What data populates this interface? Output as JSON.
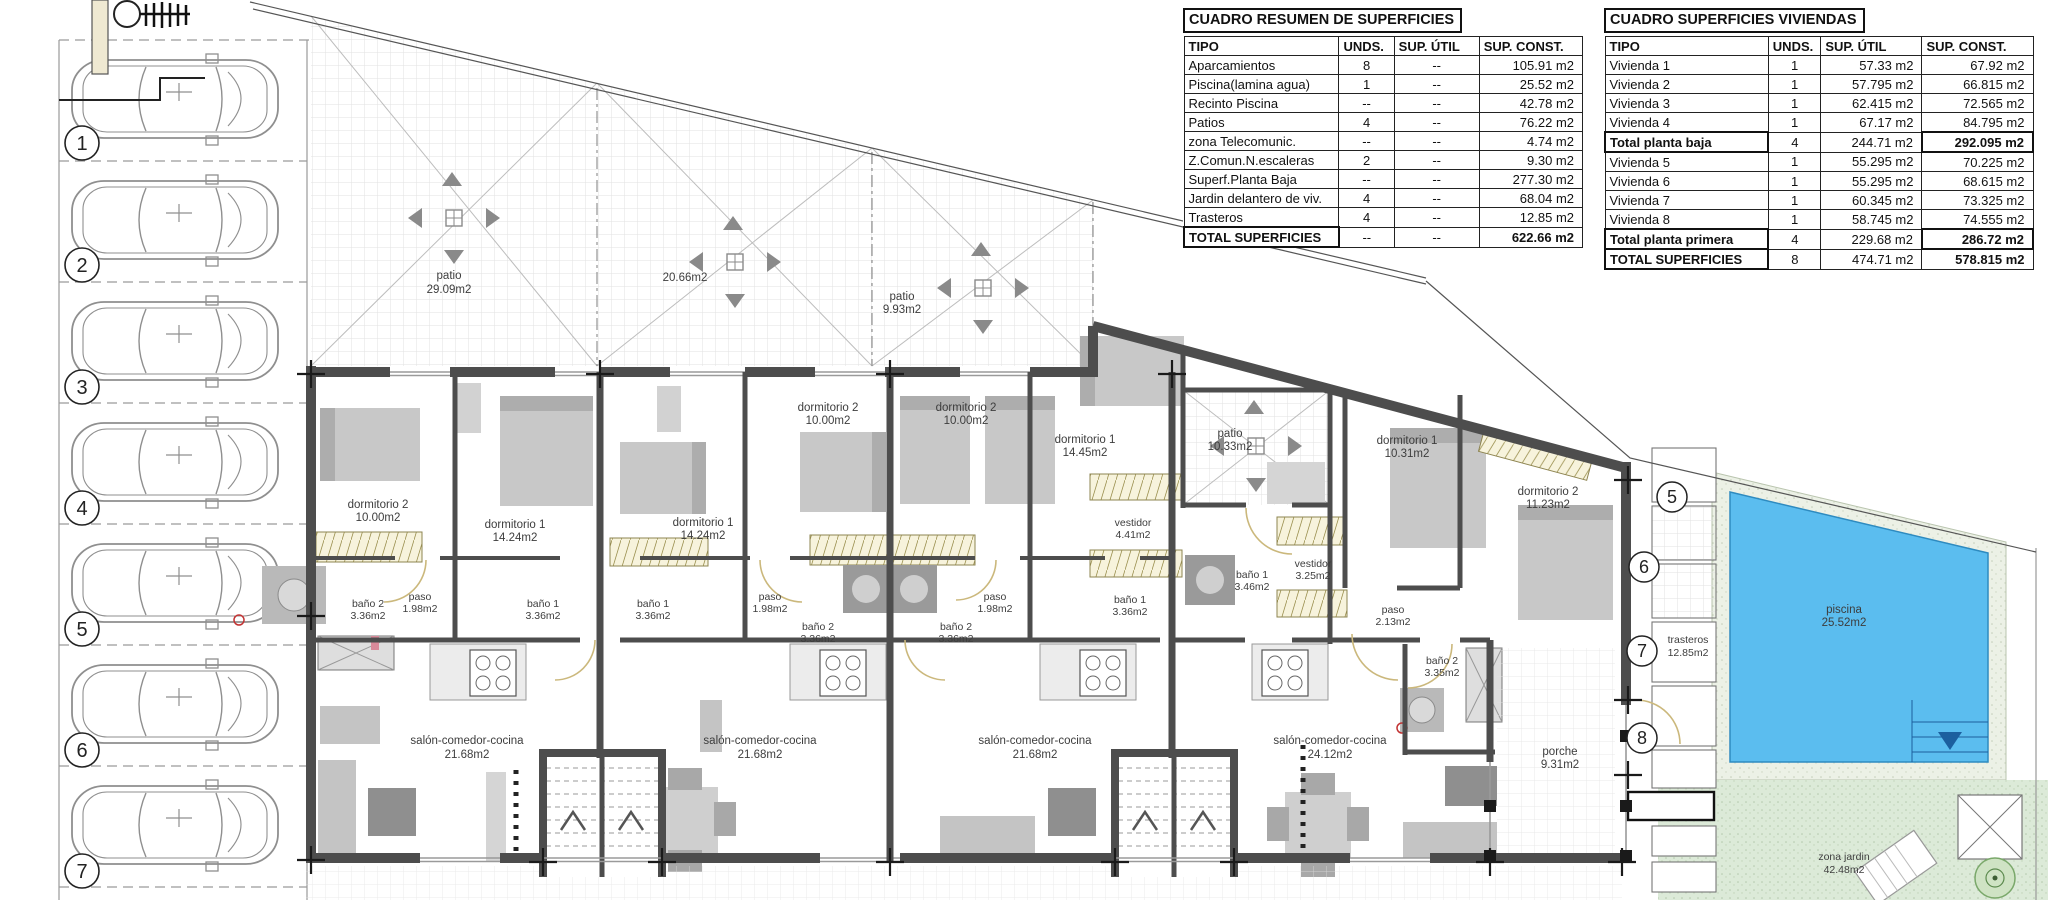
{
  "tables": {
    "resumen": {
      "title": "CUADRO RESUMEN DE SUPERFICIES",
      "headers": [
        "TIPO",
        "UNDS.",
        "SUP. ÚTIL",
        "SUP. CONST."
      ],
      "rows": [
        [
          "Aparcamientos",
          "8",
          "--",
          "105.91 m2"
        ],
        [
          "Piscina(lamina agua)",
          "1",
          "--",
          "25.52 m2"
        ],
        [
          "Recinto Piscina",
          "--",
          "--",
          "42.78 m2"
        ],
        [
          "Patios",
          "4",
          "--",
          "76.22 m2"
        ],
        [
          "zona Telecomunic.",
          "--",
          "--",
          "4.74 m2"
        ],
        [
          "Z.Comun.N.escaleras",
          "2",
          "--",
          "9.30 m2"
        ],
        [
          "Superf.Planta Baja",
          "--",
          "--",
          "277.30 m2"
        ],
        [
          "Jardin delantero de viv.",
          "4",
          "--",
          "68.04 m2"
        ],
        [
          "Trasteros",
          "4",
          "--",
          "12.85 m2"
        ]
      ],
      "total": [
        "TOTAL SUPERFICIES",
        "--",
        "--",
        "622.66 m2"
      ]
    },
    "viviendas": {
      "title": "CUADRO SUPERFICIES VIVIENDAS",
      "headers": [
        "TIPO",
        "UNDS.",
        "SUP. ÚTIL",
        "SUP. CONST."
      ],
      "rows": [
        [
          "Vivienda 1",
          "1",
          "57.33 m2",
          "67.92 m2"
        ],
        [
          "Vivienda 2",
          "1",
          "57.795 m2",
          "66.815 m2"
        ],
        [
          "Vivienda 3",
          "1",
          "62.415 m2",
          "72.565 m2"
        ],
        [
          "Vivienda 4",
          "1",
          "67.17 m2",
          "84.795 m2"
        ],
        [
          "Total planta baja",
          "4",
          "244.71 m2",
          "292.095 m2"
        ],
        [
          "Vivienda 5",
          "1",
          "55.295 m2",
          "70.225 m2"
        ],
        [
          "Vivienda 6",
          "1",
          "55.295 m2",
          "68.615 m2"
        ],
        [
          "Vivienda 7",
          "1",
          "60.345 m2",
          "73.325 m2"
        ],
        [
          "Vivienda 8",
          "1",
          "58.745 m2",
          "74.555 m2"
        ],
        [
          "Total planta primera",
          "4",
          "229.68 m2",
          "286.72 m2"
        ],
        [
          "TOTAL SUPERFICIES",
          "8",
          "474.71 m2",
          "578.815 m2"
        ]
      ]
    }
  },
  "plan": {
    "parking_numbers": [
      "1",
      "2",
      "3",
      "4",
      "5",
      "6",
      "7"
    ],
    "plot_numbers": [
      "5",
      "6",
      "7",
      "8"
    ],
    "labels": [
      {
        "name": "patio",
        "area": "29.09m2"
      },
      {
        "name": "",
        "area": "20.66m2"
      },
      {
        "name": "patio",
        "area": "9.93m2"
      },
      {
        "name": "patio",
        "area": "10.33m2"
      },
      {
        "name": "dormitorio 2",
        "area": "10.00m2"
      },
      {
        "name": "dormitorio 1",
        "area": "14.24m2"
      },
      {
        "name": "dormitorio 1",
        "area": "14.24m2"
      },
      {
        "name": "dormitorio 2",
        "area": "10.00m2"
      },
      {
        "name": "dormitorio 2",
        "area": "10.00m2"
      },
      {
        "name": "dormitorio 1",
        "area": "14.45m2"
      },
      {
        "name": "dormitorio 1",
        "area": "10.31m2"
      },
      {
        "name": "dormitorio 2",
        "area": "11.23m2"
      },
      {
        "name": "vestidor",
        "area": "4.41m2"
      },
      {
        "name": "vestidor",
        "area": "3.25m2"
      },
      {
        "name": "baño 2",
        "area": "3.36m2"
      },
      {
        "name": "paso",
        "area": "1.98m2"
      },
      {
        "name": "baño 1",
        "area": "3.36m2"
      },
      {
        "name": "baño 1",
        "area": "3.36m2"
      },
      {
        "name": "paso",
        "area": "1.98m2"
      },
      {
        "name": "baño 2",
        "area": "3.36m2"
      },
      {
        "name": "baño 2",
        "area": "3.36m2"
      },
      {
        "name": "paso",
        "area": "1.98m2"
      },
      {
        "name": "baño 1",
        "area": "3.46m2"
      },
      {
        "name": "baño 1",
        "area": "3.36m2"
      },
      {
        "name": "paso",
        "area": "2.13m2"
      },
      {
        "name": "baño 2",
        "area": "3.35m2"
      },
      {
        "name": "salón-comedor-cocina",
        "area": "21.68m2"
      },
      {
        "name": "salón-comedor-cocina",
        "area": "21.68m2"
      },
      {
        "name": "salón-comedor-cocina",
        "area": "21.68m2"
      },
      {
        "name": "salón-comedor-cocina",
        "area": "24.12m2"
      },
      {
        "name": "porche",
        "area": "9.31m2"
      },
      {
        "name": "trasteros",
        "area": "12.85m2"
      },
      {
        "name": "piscina",
        "area": "25.52m2"
      },
      {
        "name": "zona jardin",
        "area": "42.48m2"
      }
    ],
    "colors": {
      "wall": "#4d4d4d",
      "pool_blue": "#5bbdef",
      "garden_green": "#dcead8",
      "wardrobe_hatch": "#f7f3dc"
    }
  }
}
